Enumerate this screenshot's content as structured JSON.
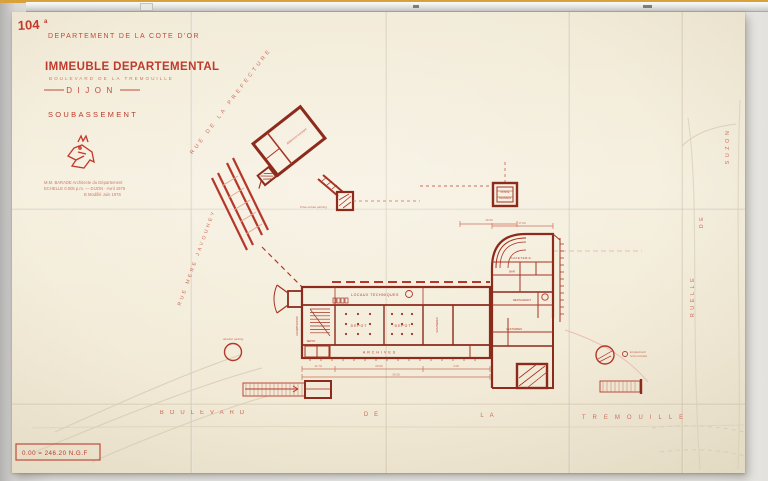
{
  "sheet": {
    "number": "104",
    "number_suffix": "a",
    "department": "DEPARTEMENT DE LA COTE D'OR",
    "title": "IMMEUBLE DEPARTEMENTAL",
    "address": "BOULEVARD DE LA TREMOUILLE",
    "city": "DIJON",
    "drawing": "SOUBASSEMENT",
    "credits": {
      "line1": "M.M. BARADE   Architecte du Département",
      "line2": "ECHELLE 0.005 p.m.  —  DIJON · Avril 1975",
      "line3": "B  Modifié  Juin 1976"
    },
    "datum": "0.00 = 246.20 N.G.F"
  },
  "streets": {
    "prefecture": "RUE DE LA PREFECTURE",
    "javouhey": "RUE MERE JAVOUHEY",
    "boulevard_w1": "BOULEVARD",
    "boulevard_w2": "DE",
    "boulevard_w3": "LA",
    "boulevard_w4": "TREMOUILLE",
    "ruelle_w1": "RUELLE",
    "ruelle_w2": "DE",
    "ruelle_w3": "SUZON"
  },
  "plan": {
    "locaux_techniques": "LOCAUX TECHNIQUES",
    "depot_a": "DEPOT",
    "depot_b": "DEPOT",
    "depot_c": "DEPOT",
    "archives": "ARCHIVES",
    "climatisation": "CLIMATISATION",
    "sanitaires": "SANITAIRES",
    "cafeteria": "CAFETERIA",
    "bar": "BAR",
    "restaurant": "RESTAURANT",
    "vestiaires": "VESTIAIRES",
    "batiment_existant": "Bâtiment existant",
    "prise_parking": "Prise entrée parking",
    "poste_l1": "POSTE",
    "poste_l2": "TRANSFO",
    "aeration": "Aération parking",
    "borne_l1": "Emplacement",
    "borne_l2": "borne incendie",
    "dims": {
      "d1": "11.70",
      "d2": "29.60",
      "d3": "4.00",
      "d4": "39.20",
      "d5": "17.60",
      "d6": "19.60"
    }
  },
  "colors": {
    "ink": "#b5372b",
    "wall": "#8c2a1c",
    "faded": "#cd6e5c",
    "pencil": "#d8cdb6",
    "paper": "#f4eedd"
  }
}
